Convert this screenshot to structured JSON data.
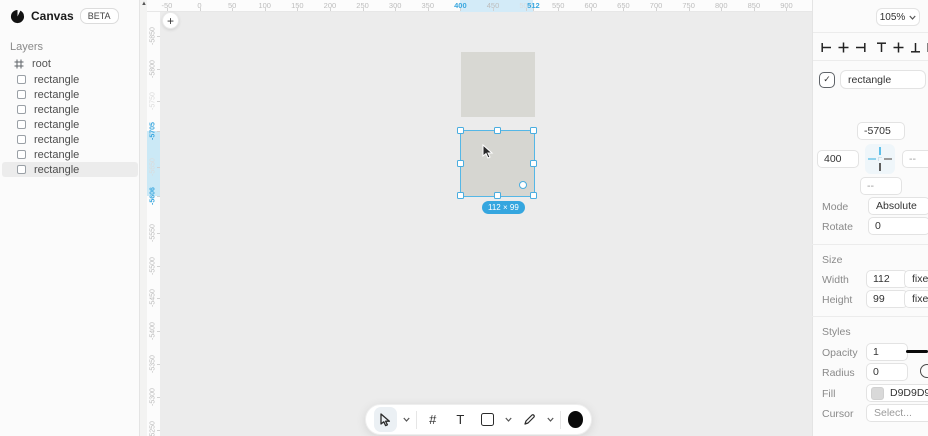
{
  "app": {
    "name": "Canvas",
    "badge": "BETA",
    "zoom": "105%"
  },
  "sidebar": {
    "layers_heading": "Layers",
    "root_label": "root",
    "layer_items": [
      "rectangle",
      "rectangle",
      "rectangle",
      "rectangle",
      "rectangle",
      "rectangle",
      "rectangle"
    ],
    "selected_index": 6
  },
  "canvas": {
    "size_badge": "112 × 99",
    "rulers": {
      "top": {
        "highlight": {
          "from": 400,
          "to": 512
        },
        "ticks": [
          {
            "v": -50,
            "label": "-50"
          },
          {
            "v": 0,
            "label": "0"
          },
          {
            "v": 50,
            "label": "50"
          },
          {
            "v": 100,
            "label": "100"
          },
          {
            "v": 150,
            "label": "150"
          },
          {
            "v": 200,
            "label": "200"
          },
          {
            "v": 250,
            "label": "250"
          },
          {
            "v": 300,
            "label": "300"
          },
          {
            "v": 350,
            "label": "350"
          },
          {
            "v": 400,
            "label": "400",
            "accent": true
          },
          {
            "v": 450,
            "label": "450"
          },
          {
            "v": 500,
            "label": "500",
            "faint": true
          },
          {
            "v": 512,
            "label": "512",
            "accent": true
          },
          {
            "v": 550,
            "label": "550"
          },
          {
            "v": 600,
            "label": "600"
          },
          {
            "v": 650,
            "label": "650"
          },
          {
            "v": 700,
            "label": "700"
          },
          {
            "v": 750,
            "label": "750"
          },
          {
            "v": 800,
            "label": "800"
          },
          {
            "v": 850,
            "label": "850"
          },
          {
            "v": 900,
            "label": "900"
          }
        ]
      },
      "left": {
        "highlight": {
          "from": -5705,
          "to": -5606
        },
        "ticks": [
          {
            "v": -5850,
            "label": "-5850"
          },
          {
            "v": -5800,
            "label": "-5800"
          },
          {
            "v": -5750,
            "label": "-5750",
            "faint": true
          },
          {
            "v": -5705,
            "label": "-5705",
            "accent": true
          },
          {
            "v": -5650,
            "label": "-5650",
            "faint": true
          },
          {
            "v": -5606,
            "label": "-5606",
            "accent": true
          },
          {
            "v": -5550,
            "label": "-5550"
          },
          {
            "v": -5500,
            "label": "-5500"
          },
          {
            "v": -5450,
            "label": "-5450"
          },
          {
            "v": -5400,
            "label": "-5400"
          },
          {
            "v": -5350,
            "label": "-5350"
          },
          {
            "v": -5300,
            "label": "-5300"
          },
          {
            "v": -5250,
            "label": "-5250"
          }
        ]
      }
    },
    "objects": [
      {
        "type": "rectangle",
        "fill": "#D8D8D3",
        "selected": false
      },
      {
        "type": "rectangle",
        "fill": "#D6D6D1",
        "selected": true
      }
    ]
  },
  "toolbar": {
    "hash_label": "#",
    "text_label": "T"
  },
  "inspector": {
    "name_value": "rectangle",
    "position_heading": "Position",
    "pos_y": "-5705",
    "pos_x": "400",
    "pos_right": "--",
    "pos_bottom": "--",
    "mode_label": "Mode",
    "mode_value": "Absolute",
    "rotate_label": "Rotate",
    "rotate_value": "0",
    "size_heading": "Size",
    "width_label": "Width",
    "width_value": "112",
    "width_mode": "fixed",
    "height_label": "Height",
    "height_value": "99",
    "height_mode": "fixed",
    "styles_heading": "Styles",
    "opacity_label": "Opacity",
    "opacity_value": "1",
    "radius_label": "Radius",
    "radius_value": "0",
    "fill_label": "Fill",
    "fill_value": "D9D9D9",
    "cursor_label": "Cursor",
    "cursor_value": "Select..."
  },
  "colors": {
    "accent": "#3AA7DF",
    "ruler_highlight": "#D3EBF8",
    "object_fill": "#D9D9D9"
  }
}
